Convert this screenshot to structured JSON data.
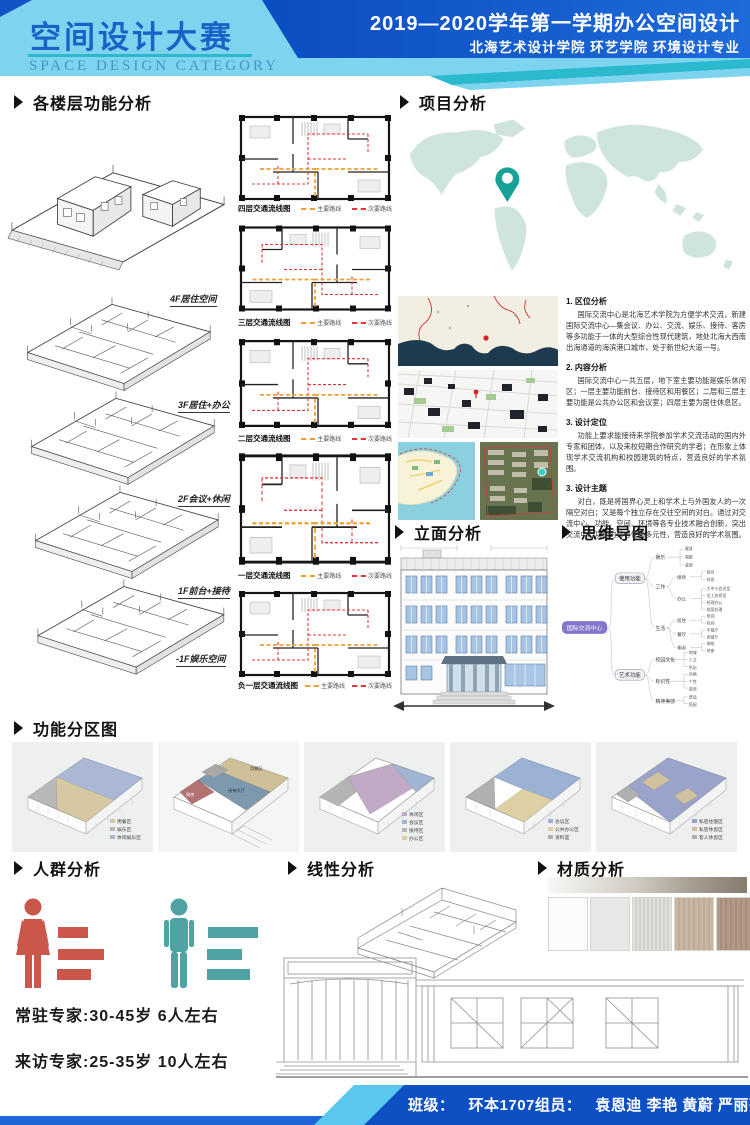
{
  "header": {
    "title_cn": "空间设计大赛",
    "title_en": "SPACE DESIGN CATEGORY",
    "course_line": "2019—2020学年第一学期办公空间设计",
    "school_line": "北海艺术设计学院  环艺学院  环境设计专业",
    "colors": {
      "banner_light": "#7ed3ef",
      "banner_dark": "#0d53c6",
      "accent_teal": "#2ab9cd",
      "title_blue": "#1b62c8"
    }
  },
  "section_titles": {
    "floors": "各楼层功能分析",
    "project": "项目分析",
    "elevation": "立面分析",
    "mindmap": "思维导图",
    "zoning": "功能分区图",
    "people": "人群分析",
    "linear": "线性分析",
    "material": "材质分析"
  },
  "floor_labels": [
    "4F居住空间",
    "3F居住+办公",
    "2F会议+休闲",
    "1F前台+接待",
    "-1F娱乐空间"
  ],
  "plans": {
    "labels": [
      "四层交通流线图",
      "三层交通流线图",
      "二层交通流线图",
      "一层交通流线图",
      "负一层交通流线图"
    ],
    "legend_main": "主要路线",
    "legend_sub": "次要路线",
    "main_color": "#f0a030",
    "sub_color": "#e03838"
  },
  "project_text": [
    {
      "heading": "1. 区位分析",
      "body": "国际交流中心是北海艺术学院为方便学术交流，新建国际交流中心—集会议、办公、交流、娱乐、接待、客房等多功能于一体的大型综合性现代建筑，地处北海大西南出海通道的海滨港口城市，处于新世纪大道一号。"
    },
    {
      "heading": "2. 内容分析",
      "body": "国际交流中心一共五层，地下室主要功能是娱乐休闲区；一层主要功能前台、接待区和用餐区；二层和三层主要功能是公共办公区和会议室；四层主要为居住休息区。"
    },
    {
      "heading": "3. 设计定位",
      "body": "功能上要求能接待来学院参加学术交流活动的国内外专家和团体，以及来校短期合作研究的学者；在形象上体现学术交流机构和校园建筑的特点，营造良好的学术氛围。"
    },
    {
      "heading": "3. 设计主题",
      "body": "对白，既是将国界心灵上和学术上与外国友人的一次隔空对白；又是每个独立存在交往空间的对白。通过对交流中心、功能、空间、环境等各专业技术融合创新，突出交流中心功能的综合性和多元性，营造良好的学术氛围。"
    }
  ],
  "mindmap": {
    "center": "国际交流中心",
    "branches": [
      "使用功能",
      "艺术功能"
    ],
    "use_children": [
      "娱乐",
      "工作",
      "生活"
    ],
    "art_children": [
      "校园文化",
      "标识性",
      "精神美感"
    ],
    "leaves": {
      "yule": [
        "健身",
        "唱歌",
        "桌游"
      ],
      "work": [
        "接待",
        "办公"
      ],
      "jiedai": [
        "前台",
        "休息"
      ],
      "bangong": [
        "大中小会议室",
        "员工休息室",
        "经理办公",
        "档案处理"
      ],
      "life": [
        "居住",
        "餐饮",
        "休闲"
      ],
      "juzhu": [
        "单间",
        "标间"
      ],
      "canyin": [
        "中餐厅",
        "西餐厅"
      ],
      "xiuxian": [
        "咖啡",
        "茶座"
      ],
      "campus": [
        "地域",
        "人文",
        "色彩"
      ],
      "biaoshi": [
        "风格",
        "个性",
        "装饰"
      ],
      "jingshen": [
        "舒适",
        "搭配"
      ]
    }
  },
  "zoning": [
    {
      "legend": [
        {
          "color": "#d6c8a2",
          "label": "用餐区"
        },
        {
          "color": "#b8b8b8",
          "label": "娱乐区"
        },
        {
          "color": "#aab8d6",
          "label": "休闲娱乐区"
        }
      ]
    },
    {
      "zone_labels": [
        "用餐区",
        "接待大厅",
        "厨房"
      ]
    },
    {
      "legend": [
        {
          "color": "#c0aac6",
          "label": "休闲区"
        },
        {
          "color": "#a0b4d4",
          "label": "会议区"
        },
        {
          "color": "#b4b4b4",
          "label": "接待区"
        },
        {
          "color": "#ddd0a4",
          "label": "办公区"
        }
      ]
    },
    {
      "legend": [
        {
          "color": "#9cb2d4",
          "label": "会议区"
        },
        {
          "color": "#ddd0a4",
          "label": "公共办公区"
        },
        {
          "color": "#b0b0b0",
          "label": "资料室"
        }
      ]
    },
    {
      "legend": [
        {
          "color": "#9aa4ca",
          "label": "私密住宿区"
        },
        {
          "color": "#cfc0a0",
          "label": "私密休息区"
        },
        {
          "color": "#b0b0b0",
          "label": "客人休息区"
        }
      ]
    }
  ],
  "people": {
    "resident": "常驻专家:30-45岁 6人左右",
    "visiting": "来访专家:25-35岁 10人左右",
    "female_color": "#c9574a",
    "male_color": "#4fa3a3"
  },
  "footer": {
    "class_label": "班级：",
    "class_value": "环本1707",
    "team_label": "组员：",
    "team_value": "袁恩迪 李艳 黄蔚 严丽芬"
  }
}
